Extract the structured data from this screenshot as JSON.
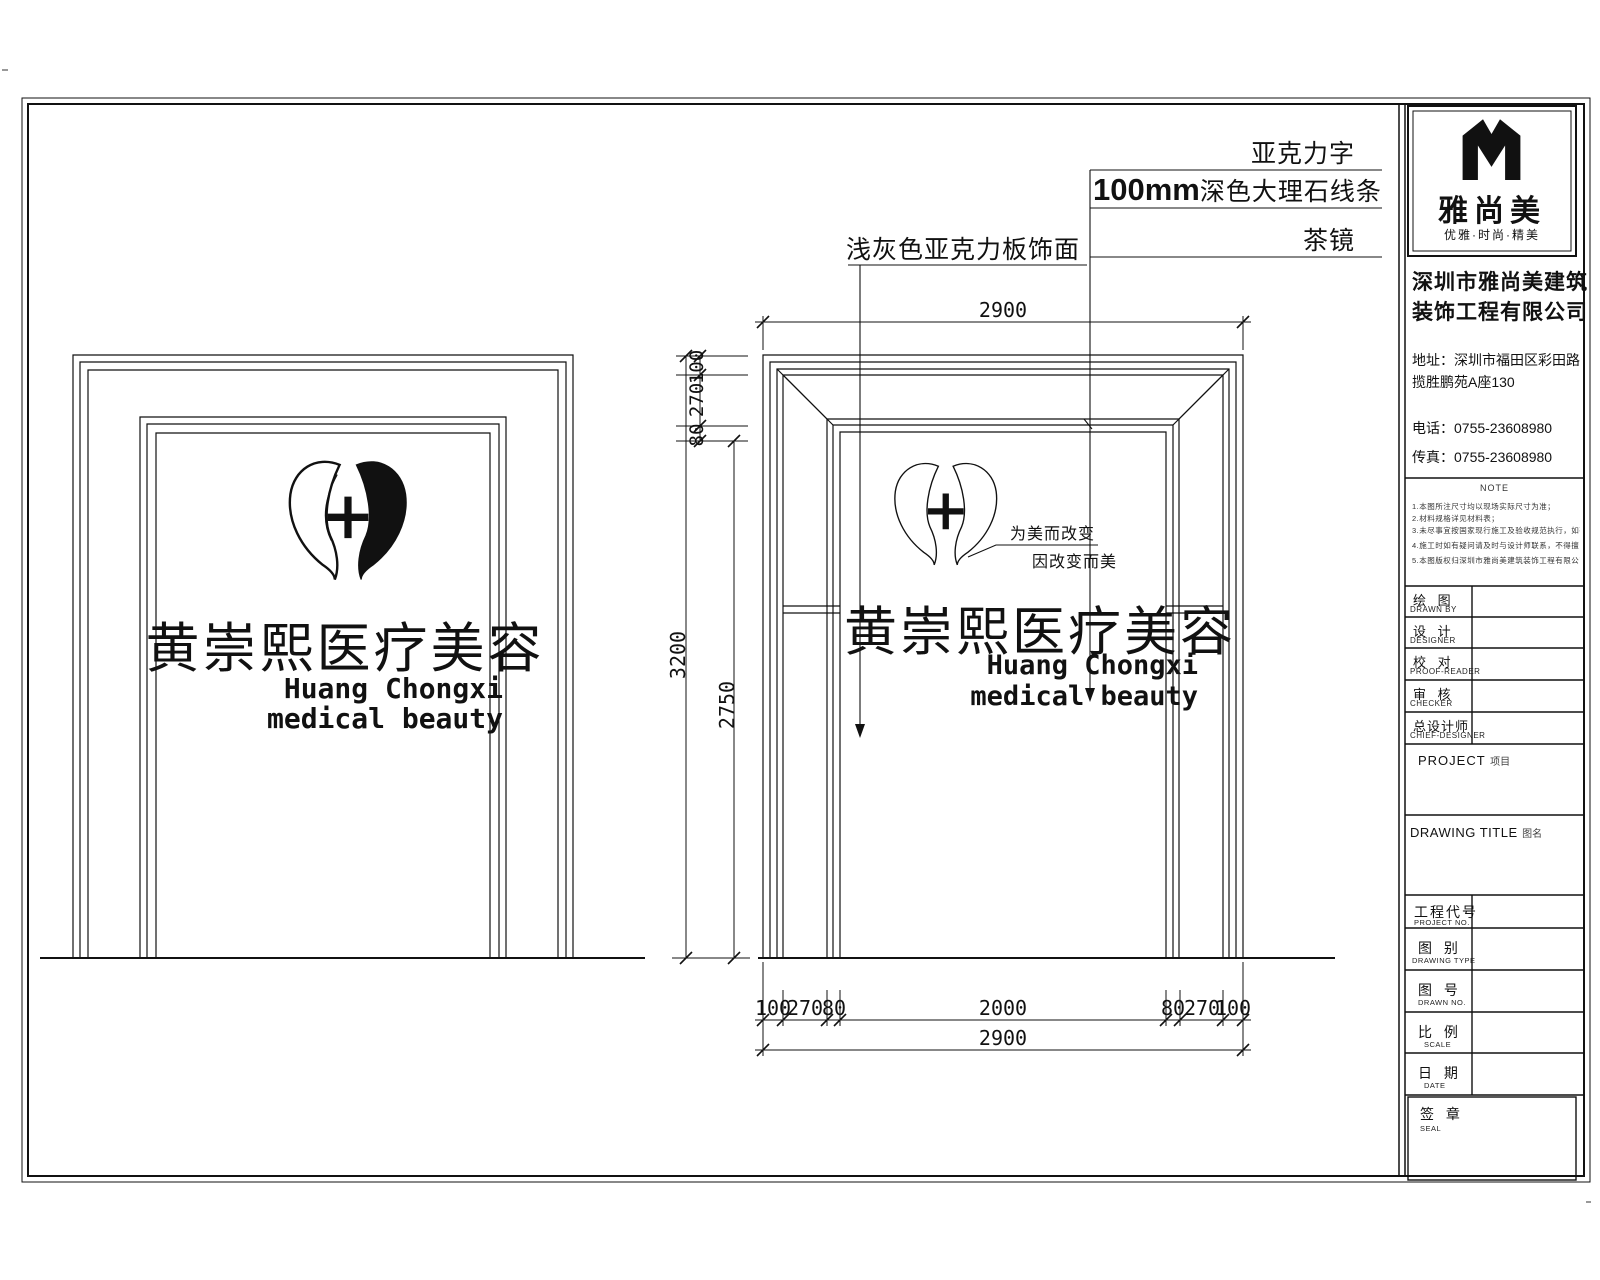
{
  "annotations": {
    "acrylic_letters": "亚克力字",
    "marble_prefix": "100mm",
    "marble_suffix": "深色大理石线条",
    "acrylic_panel": "浅灰色亚克力板饰面",
    "tea_mirror": "茶镜"
  },
  "signage": {
    "title_cn": "黄崇熙医疗美容",
    "title_en_line1": "Huang Chongxi",
    "title_en_line2": "medical beauty",
    "slogan_line1": "为美而改变",
    "slogan_line2": "因改变而美",
    "logo_plus": "+"
  },
  "dimensions": {
    "top_total": "2900",
    "height_total": "3200",
    "opening_height": "2750",
    "top_stack": [
      "100",
      "270",
      "80"
    ],
    "bottom_segments": [
      "100",
      "270",
      "80",
      "2000",
      "80",
      "270",
      "100"
    ],
    "bottom_total": "2900"
  },
  "titleblock": {
    "brand": {
      "name": "雅尚美",
      "tagline": "优雅·时尚·精美"
    },
    "company": {
      "name_line1": "深圳市雅尚美建筑",
      "name_line2": "装饰工程有限公司",
      "address_line1": "地址：深圳市福田区彩田路",
      "address_line2": "揽胜鹏苑A座130",
      "phone": "电话：0755-23608980",
      "fax": "传真：0755-23608980"
    },
    "note": {
      "title": "NOTE",
      "lines": [
        "1.本图所注尺寸均以现场实际尺寸为准；",
        "2.材料规格详见材料表；",
        "3.未尽事宜按国家现行施工及验收规范执行，如有修改以设计师确认为准；",
        "4.施工时如有疑问请及时与设计师联系，不得擅自更改图纸内容；",
        "5.本图版权归深圳市雅尚美建筑装饰工程有限公司所有，翻版必究。"
      ]
    },
    "rows": [
      {
        "cn": "绘 图",
        "en": "DRAWN BY"
      },
      {
        "cn": "设 计",
        "en": "DESIGNER"
      },
      {
        "cn": "校 对",
        "en": "PROOF-READER"
      },
      {
        "cn": "审 核",
        "en": "CHECKER"
      },
      {
        "cn": "总设计师",
        "en": "CHIEF-DESIGNER"
      }
    ],
    "project_label_en": "PROJECT",
    "project_label_cn": "项目",
    "drawing_title_label_en": "DRAWING TITLE",
    "drawing_title_label_cn": "图名",
    "fields": [
      {
        "cn": "工程代号",
        "en": "PROJECT NO."
      },
      {
        "cn": "图 别",
        "en": "DRAWING TYPE"
      },
      {
        "cn": "图 号",
        "en": "DRAWN NO."
      },
      {
        "cn": "比 例",
        "en": "SCALE"
      },
      {
        "cn": "日 期",
        "en": "DATE"
      }
    ],
    "seal": {
      "cn": "签 章",
      "en": "SEAL"
    }
  }
}
